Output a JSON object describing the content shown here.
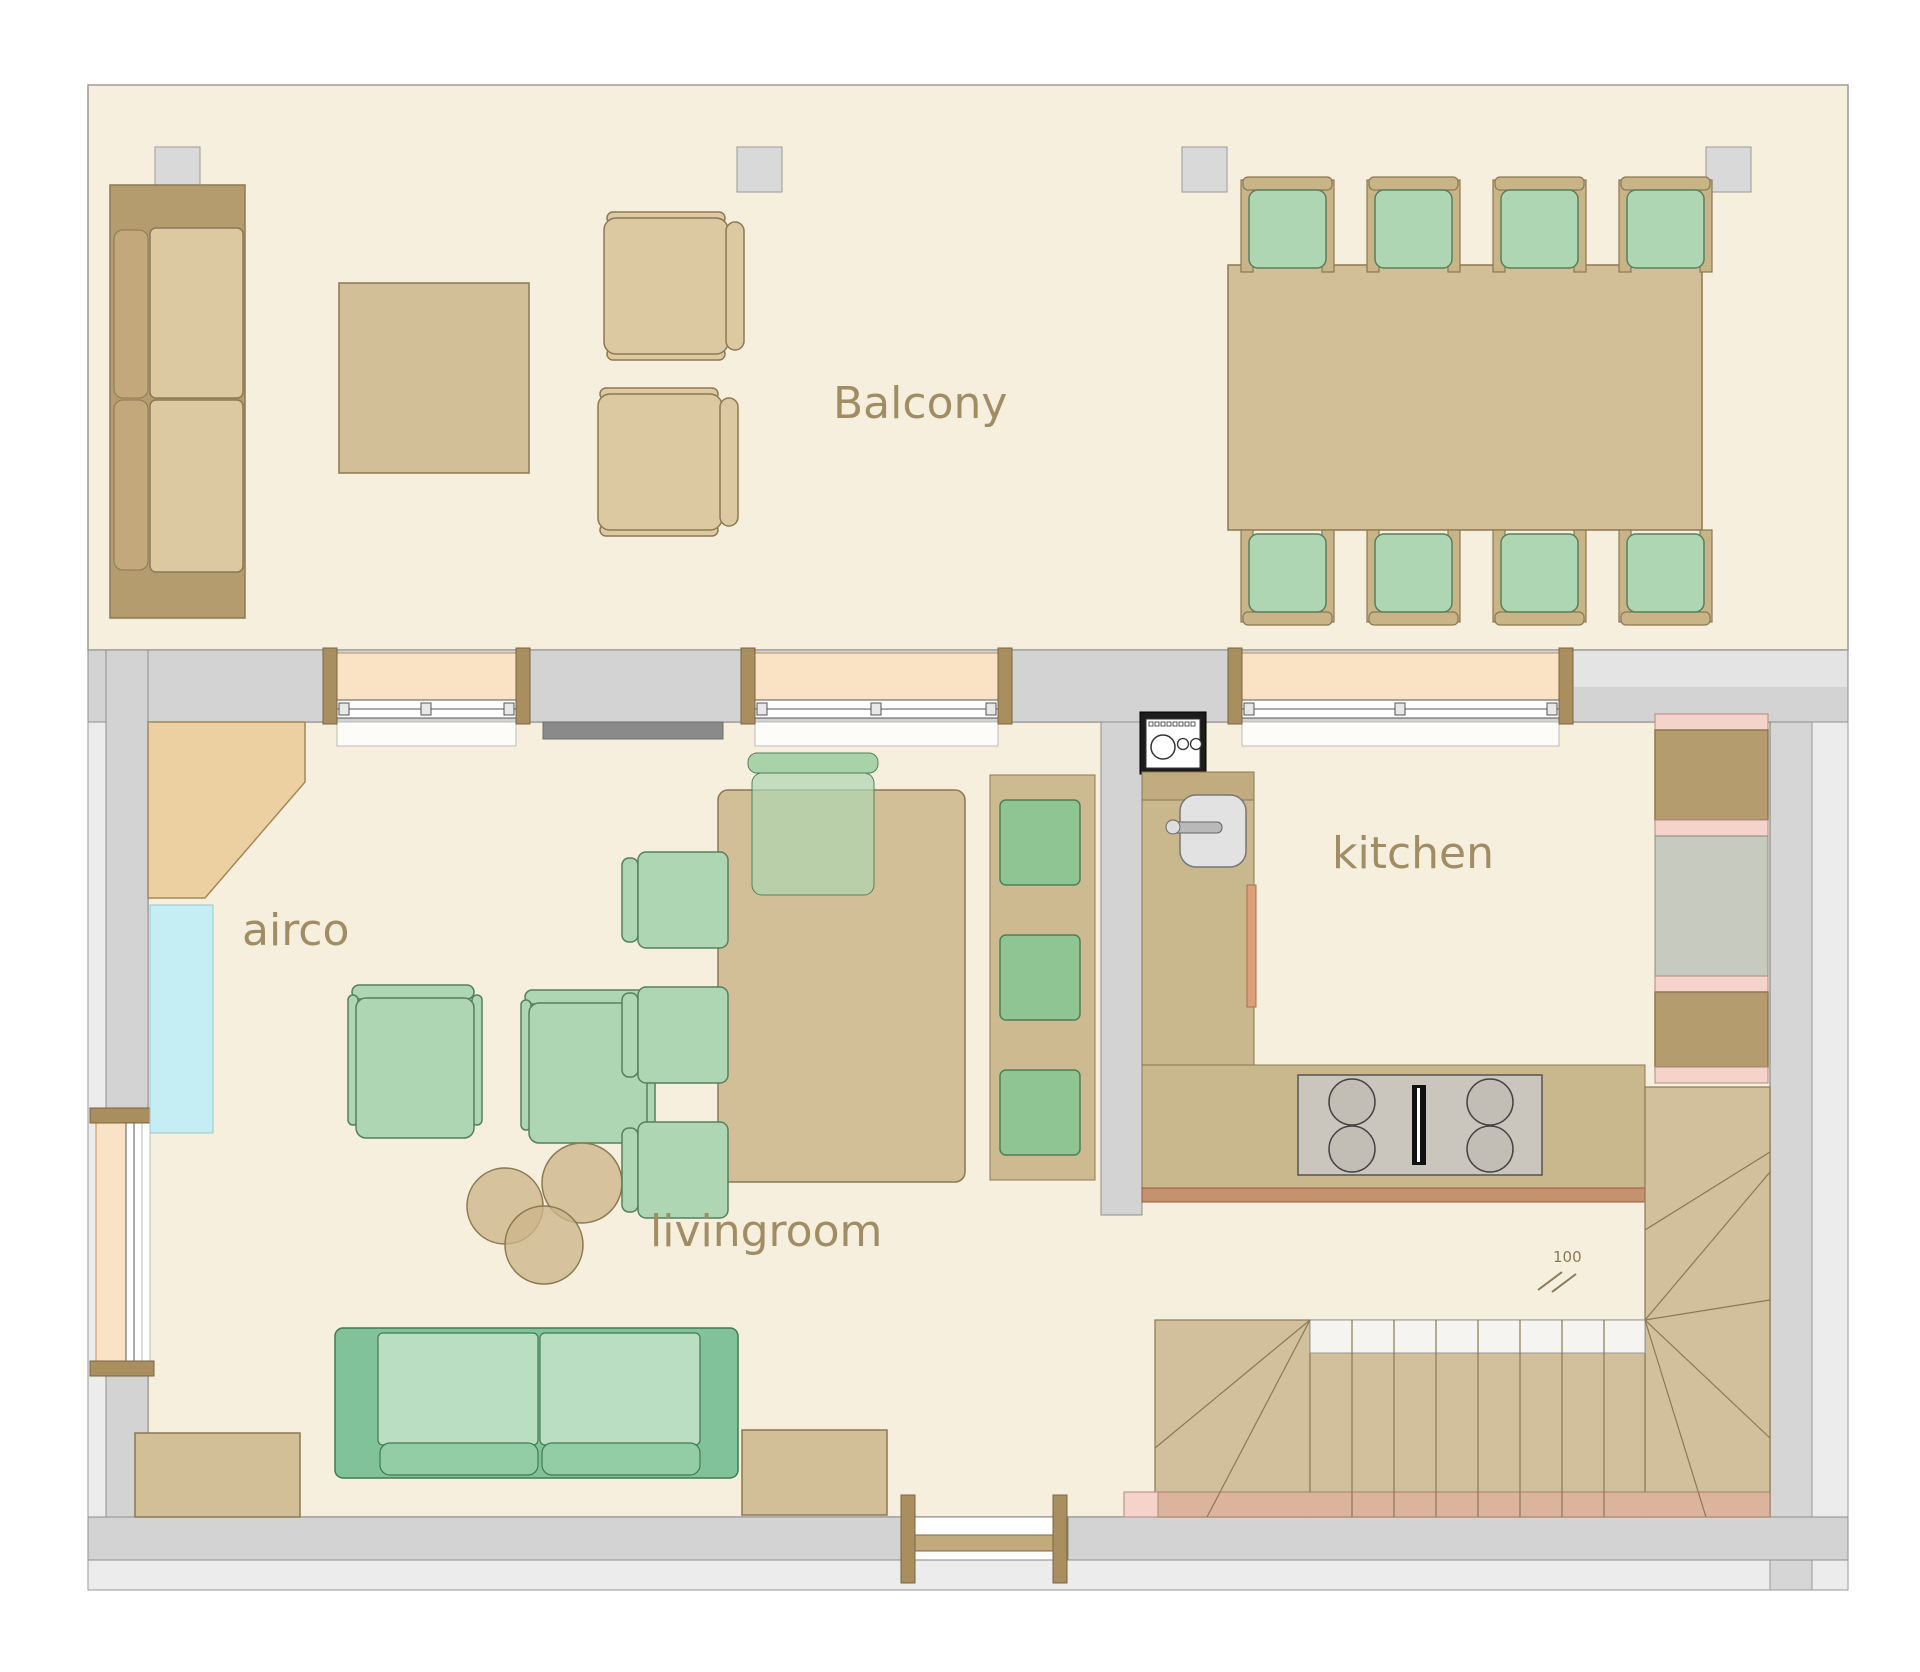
{
  "labels": {
    "balcony": "Balcony",
    "airco": "airco",
    "kitchen": "kitchen",
    "livingroom": "livingroom"
  },
  "stairs": {
    "level_marker": "100"
  },
  "palette": {
    "floor_cream": "#f6efdd",
    "wall_gray": "#d3d3d3",
    "outer_wall": "#ececec",
    "furniture_tan": "#d2bf97",
    "furniture_brown": "#b59c6e",
    "cushion_cream": "#dcc9a1",
    "chair_green_light": "#aed6b2",
    "chair_green_dark": "#8fc493",
    "sofa_green": "#82c29b",
    "window_sill_peach": "#fae3c5",
    "airco_cyan": "#c4eef3",
    "cabinet_pink": "#f5d2ca",
    "stair_salmon": "#dcb39c",
    "label_text": "#a08d64"
  },
  "rooms": [
    {
      "name": "Balcony",
      "furniture": [
        "outdoor-sofa",
        "square-coffee-table",
        "lounge-chair",
        "lounge-chair",
        "dining-table-8-seats",
        "8 chairs with green cushions",
        "4 support columns"
      ]
    },
    {
      "name": "livingroom",
      "furniture": [
        "corner-wardrobe",
        "airco-unit",
        "armchair",
        "armchair",
        "3 round nesting tables",
        "green-sofa",
        "side-table",
        "low-cabinet",
        "tv",
        "dining-table",
        "4 green chairs",
        "bench with 3 cushions"
      ]
    },
    {
      "name": "kitchen",
      "furniture": [
        "washer-or-oven",
        "counter-with-sink",
        "island-counter",
        "stove-4-burners",
        "tall-cabinets",
        "fridge"
      ]
    }
  ]
}
